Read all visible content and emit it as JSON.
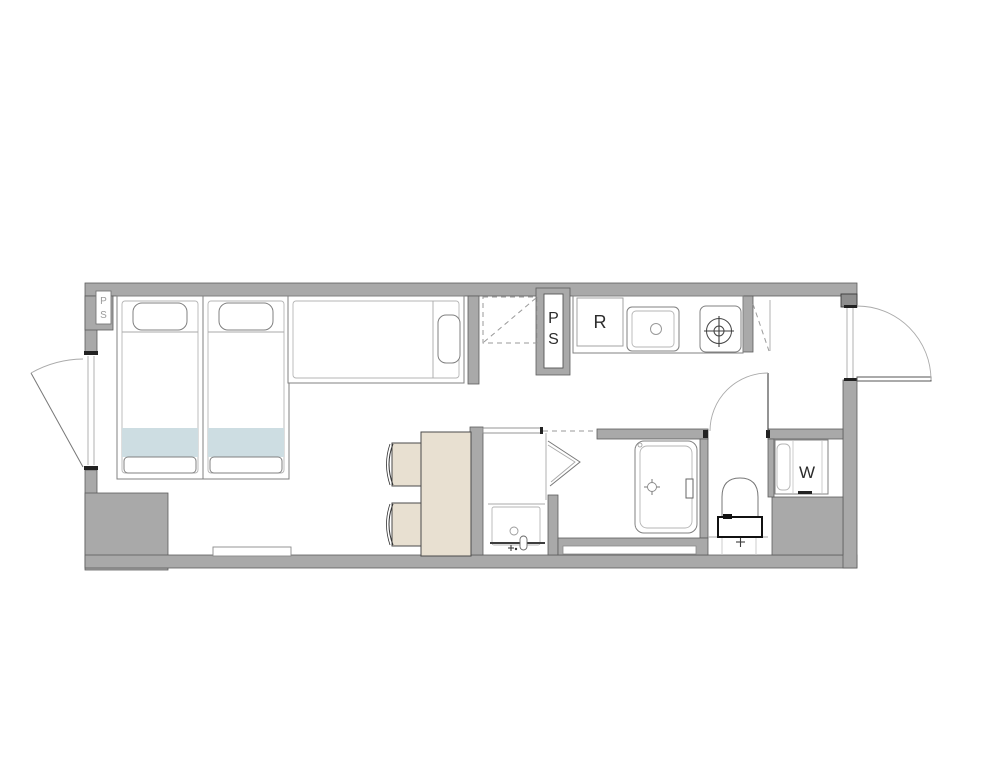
{
  "labels": {
    "pipe_shaft_corner": {
      "line1": "P",
      "line2": "S"
    },
    "pipe_shaft_main": {
      "line1": "P",
      "line2": "S"
    },
    "refrigerator": "R",
    "washer": "W"
  },
  "colors": {
    "background": "#ffffff",
    "wall": "#a9a9a9",
    "wall_dark": "#8e8e8e",
    "furniture_beige": "#e8e0d1",
    "bed_blanket_blue": "#cddde2"
  }
}
